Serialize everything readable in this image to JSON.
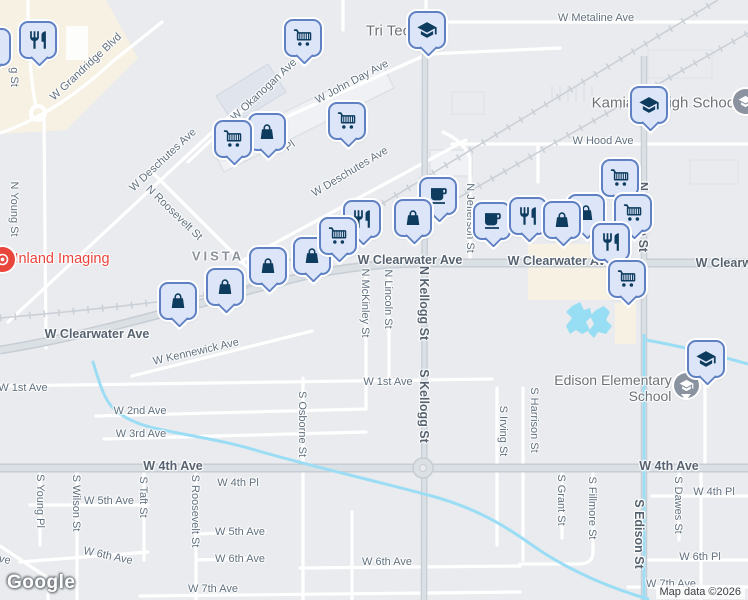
{
  "map": {
    "attribution": "Map data ©2026",
    "logo_text": "Google",
    "colors": {
      "land": "#e9ebee",
      "commercial_area": "#f6f1e2",
      "water": "#9bddf4",
      "road_minor": "#ffffff",
      "road_major": "#dbe0e5",
      "road_casing": "#c7cdd4",
      "railroad": "#cbd0d7",
      "marker_fill": "#dde6f9",
      "marker_border": "#5f80c2",
      "marker_icon": "#0e3c5e",
      "street_label": "#61707f",
      "poi_label": "#6d7176",
      "red_poi": "#e8453c",
      "school_poi_circle": "#8a939f"
    },
    "street_labels": [
      {
        "text": "W Grandridge Blvd",
        "x": 86,
        "y": 67,
        "rot": -43
      },
      {
        "text": "g St",
        "x": 14,
        "y": 77,
        "rot": 90
      },
      {
        "text": "N Young St",
        "x": 14,
        "y": 209,
        "rot": 90
      },
      {
        "text": "W Okanogan Ave",
        "x": 264,
        "y": 90,
        "rot": -43
      },
      {
        "text": "W John Day Ave",
        "x": 352,
        "y": 82,
        "rot": -28
      },
      {
        "text": "W Metaline Ave",
        "x": 596,
        "y": 18,
        "rot": 0
      },
      {
        "text": "W Hood Ave",
        "x": 603,
        "y": 141,
        "rot": 0
      },
      {
        "text": "W Deschutes Ave",
        "x": 163,
        "y": 160,
        "rot": -43
      },
      {
        "text": "W Deschutes Ave",
        "x": 350,
        "y": 172,
        "rot": -31
      },
      {
        "text": "N Roosevelt St",
        "x": 174,
        "y": 213,
        "rot": 44
      },
      {
        "text": "Pl",
        "x": 290,
        "y": 146,
        "rot": -35
      },
      {
        "text": "N Jefferson St",
        "x": 470,
        "y": 218,
        "rot": 90
      },
      {
        "text": "N Edison St",
        "x": 643,
        "y": 217,
        "rot": 90,
        "cls": "major"
      },
      {
        "text": "VISTA",
        "x": 218,
        "y": 256,
        "cls": "locality"
      },
      {
        "text": "W Clearwater Ave",
        "x": 97,
        "y": 334,
        "cls": "major"
      },
      {
        "text": "W Clearwater Ave",
        "x": 410,
        "y": 260,
        "cls": "major"
      },
      {
        "text": "W Clearwater Ave",
        "x": 560,
        "y": 261,
        "cls": "major"
      },
      {
        "text": "W Clearwater Ave",
        "x": 748,
        "y": 263,
        "cls": "major"
      },
      {
        "text": "N McKinley St",
        "x": 365,
        "y": 303,
        "rot": 90
      },
      {
        "text": "N Lincoln St",
        "x": 388,
        "y": 299,
        "rot": 90
      },
      {
        "text": "N Kellogg St",
        "x": 424,
        "y": 303,
        "rot": 90,
        "cls": "major"
      },
      {
        "text": "S Kellogg St",
        "x": 424,
        "y": 406,
        "rot": 90,
        "cls": "major"
      },
      {
        "text": "W Kennewick Ave",
        "x": 196,
        "y": 352,
        "rot": -13
      },
      {
        "text": "W 1st Ave",
        "x": 23,
        "y": 388,
        "rot": 0
      },
      {
        "text": "W 1st Ave",
        "x": 388,
        "y": 382,
        "rot": 0
      },
      {
        "text": "W 2nd Ave",
        "x": 140,
        "y": 411,
        "rot": 0
      },
      {
        "text": "W 3rd Ave",
        "x": 141,
        "y": 434,
        "rot": 0
      },
      {
        "text": "S Osborne St",
        "x": 302,
        "y": 424,
        "rot": 90
      },
      {
        "text": "S Irving St",
        "x": 503,
        "y": 431,
        "rot": 90
      },
      {
        "text": "S Harrison St",
        "x": 534,
        "y": 420,
        "rot": 90
      },
      {
        "text": "W 4th Ave",
        "x": 173,
        "y": 466,
        "cls": "major"
      },
      {
        "text": "W 4th Ave",
        "x": 669,
        "y": 466,
        "cls": "major"
      },
      {
        "text": "W 4th Pl",
        "x": 238,
        "y": 483,
        "rot": 0
      },
      {
        "text": "W 4th Pl",
        "x": 714,
        "y": 492,
        "rot": 0
      },
      {
        "text": "S Young Pl",
        "x": 40,
        "y": 501,
        "rot": 90
      },
      {
        "text": "S Wilson St",
        "x": 76,
        "y": 503,
        "rot": 90
      },
      {
        "text": "S Taft St",
        "x": 143,
        "y": 497,
        "rot": 90
      },
      {
        "text": "S Roosevelt St",
        "x": 195,
        "y": 511,
        "rot": 90
      },
      {
        "text": "S Grant St",
        "x": 561,
        "y": 500,
        "rot": 90
      },
      {
        "text": "S Fillmore St",
        "x": 592,
        "y": 508,
        "rot": 90
      },
      {
        "text": "S Edison St",
        "x": 639,
        "y": 534,
        "rot": 90,
        "cls": "major"
      },
      {
        "text": "S Dawes St",
        "x": 678,
        "y": 505,
        "rot": 90
      },
      {
        "text": "W 5th Ave",
        "x": 109,
        "y": 501,
        "rot": 0
      },
      {
        "text": "W 5th Ave",
        "x": 240,
        "y": 532,
        "rot": 0
      },
      {
        "text": "W 6th Ave",
        "x": -14,
        "y": 556,
        "rot": 12
      },
      {
        "text": "W 6th Ave",
        "x": 108,
        "y": 556,
        "rot": 12
      },
      {
        "text": "W 6th Ave",
        "x": 240,
        "y": 559,
        "rot": 0
      },
      {
        "text": "W 6th Ave",
        "x": 387,
        "y": 562,
        "rot": 0
      },
      {
        "text": "W 6th Pl",
        "x": 700,
        "y": 557,
        "rot": 0
      },
      {
        "text": "W 7th Ave",
        "x": 213,
        "y": 589,
        "rot": 0
      },
      {
        "text": "W 7th Ave",
        "x": 671,
        "y": 584,
        "rot": 0
      },
      {
        "text": "Tri Tec",
        "x": 388,
        "y": 31,
        "cls": "poi"
      },
      {
        "text": "Kamiakin High School",
        "x": 665,
        "y": 103,
        "cls": "poi"
      },
      {
        "text": "Edison Elementary",
        "x": 613,
        "y": 380,
        "cls": "poi2"
      },
      {
        "text": "School",
        "x": 650,
        "y": 396,
        "cls": "poi2"
      },
      {
        "text": "Inland Imaging",
        "x": 62,
        "y": 259,
        "cls": "red"
      }
    ],
    "poi_markers": [
      {
        "icon": "school",
        "x": 427,
        "y": 30
      },
      {
        "icon": "cart",
        "x": 303,
        "y": 38
      },
      {
        "icon": "restaurant",
        "x": 38,
        "y": 40
      },
      {
        "icon": "bag",
        "x": -8,
        "y": 47
      },
      {
        "icon": "school",
        "x": 649,
        "y": 105
      },
      {
        "icon": "cart",
        "x": 347,
        "y": 121
      },
      {
        "icon": "bag",
        "x": 267,
        "y": 132
      },
      {
        "icon": "cart",
        "x": 233,
        "y": 139
      },
      {
        "icon": "cart",
        "x": 620,
        "y": 178
      },
      {
        "icon": "cafe",
        "x": 438,
        "y": 196
      },
      {
        "icon": "cart",
        "x": 633,
        "y": 213
      },
      {
        "icon": "bag",
        "x": 586,
        "y": 213
      },
      {
        "icon": "cafe",
        "x": 492,
        "y": 221
      },
      {
        "icon": "restaurant",
        "x": 528,
        "y": 216
      },
      {
        "icon": "bag",
        "x": 562,
        "y": 220
      },
      {
        "icon": "restaurant",
        "x": 611,
        "y": 242
      },
      {
        "icon": "cart",
        "x": 627,
        "y": 279
      },
      {
        "icon": "bag",
        "x": 413,
        "y": 218
      },
      {
        "icon": "restaurant",
        "x": 362,
        "y": 219
      },
      {
        "icon": "bag",
        "x": 312,
        "y": 256
      },
      {
        "icon": "cart",
        "x": 338,
        "y": 236
      },
      {
        "icon": "bag",
        "x": 268,
        "y": 266
      },
      {
        "icon": "bag",
        "x": 225,
        "y": 287
      },
      {
        "icon": "bag",
        "x": 178,
        "y": 301
      },
      {
        "icon": "school",
        "x": 706,
        "y": 359
      }
    ],
    "circle_pois": [
      {
        "icon": "radiology",
        "name": "inland-imaging-poi",
        "color": "#e8453c",
        "x": 2,
        "y": 259,
        "tail": false
      },
      {
        "icon": "school",
        "name": "kamiakin-school-poi",
        "color": "#8a939f",
        "x": 745,
        "y": 101,
        "tail": false
      },
      {
        "icon": "school",
        "name": "edison-school-poi",
        "color": "#8a939f",
        "x": 686,
        "y": 385,
        "tail": true
      }
    ]
  }
}
